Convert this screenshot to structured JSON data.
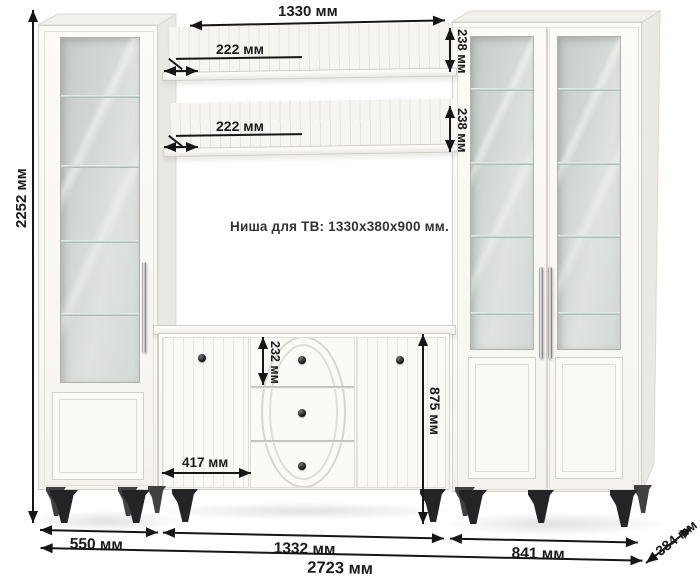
{
  "diagram_title": "furniture-wall-unit-dimension-diagram",
  "note": {
    "tv_niche": "Ниша для ТВ: 1330x380x900 мм."
  },
  "dimensions": {
    "total_height": "2252 мм",
    "niche_width": "1330 мм",
    "shelf_top_depth": "222 мм",
    "shelf_bottom_depth": "222 мм",
    "shelf_top_height": "238 мм",
    "shelf_bottom_height": "238 мм",
    "drawer_height": "232 мм",
    "stand_door_width": "417 мм",
    "stand_height": "875 мм",
    "left_cabinet_width": "550 мм",
    "stand_width": "1332 мм",
    "right_cabinet_width": "841 мм",
    "total_width": "2723 мм",
    "depth": "384 мм"
  },
  "colors": {
    "furniture_white": "#faf9f6",
    "annotation_black": "#161616",
    "leg_black": "#242427",
    "glass_tint": "#d3d7d4"
  }
}
